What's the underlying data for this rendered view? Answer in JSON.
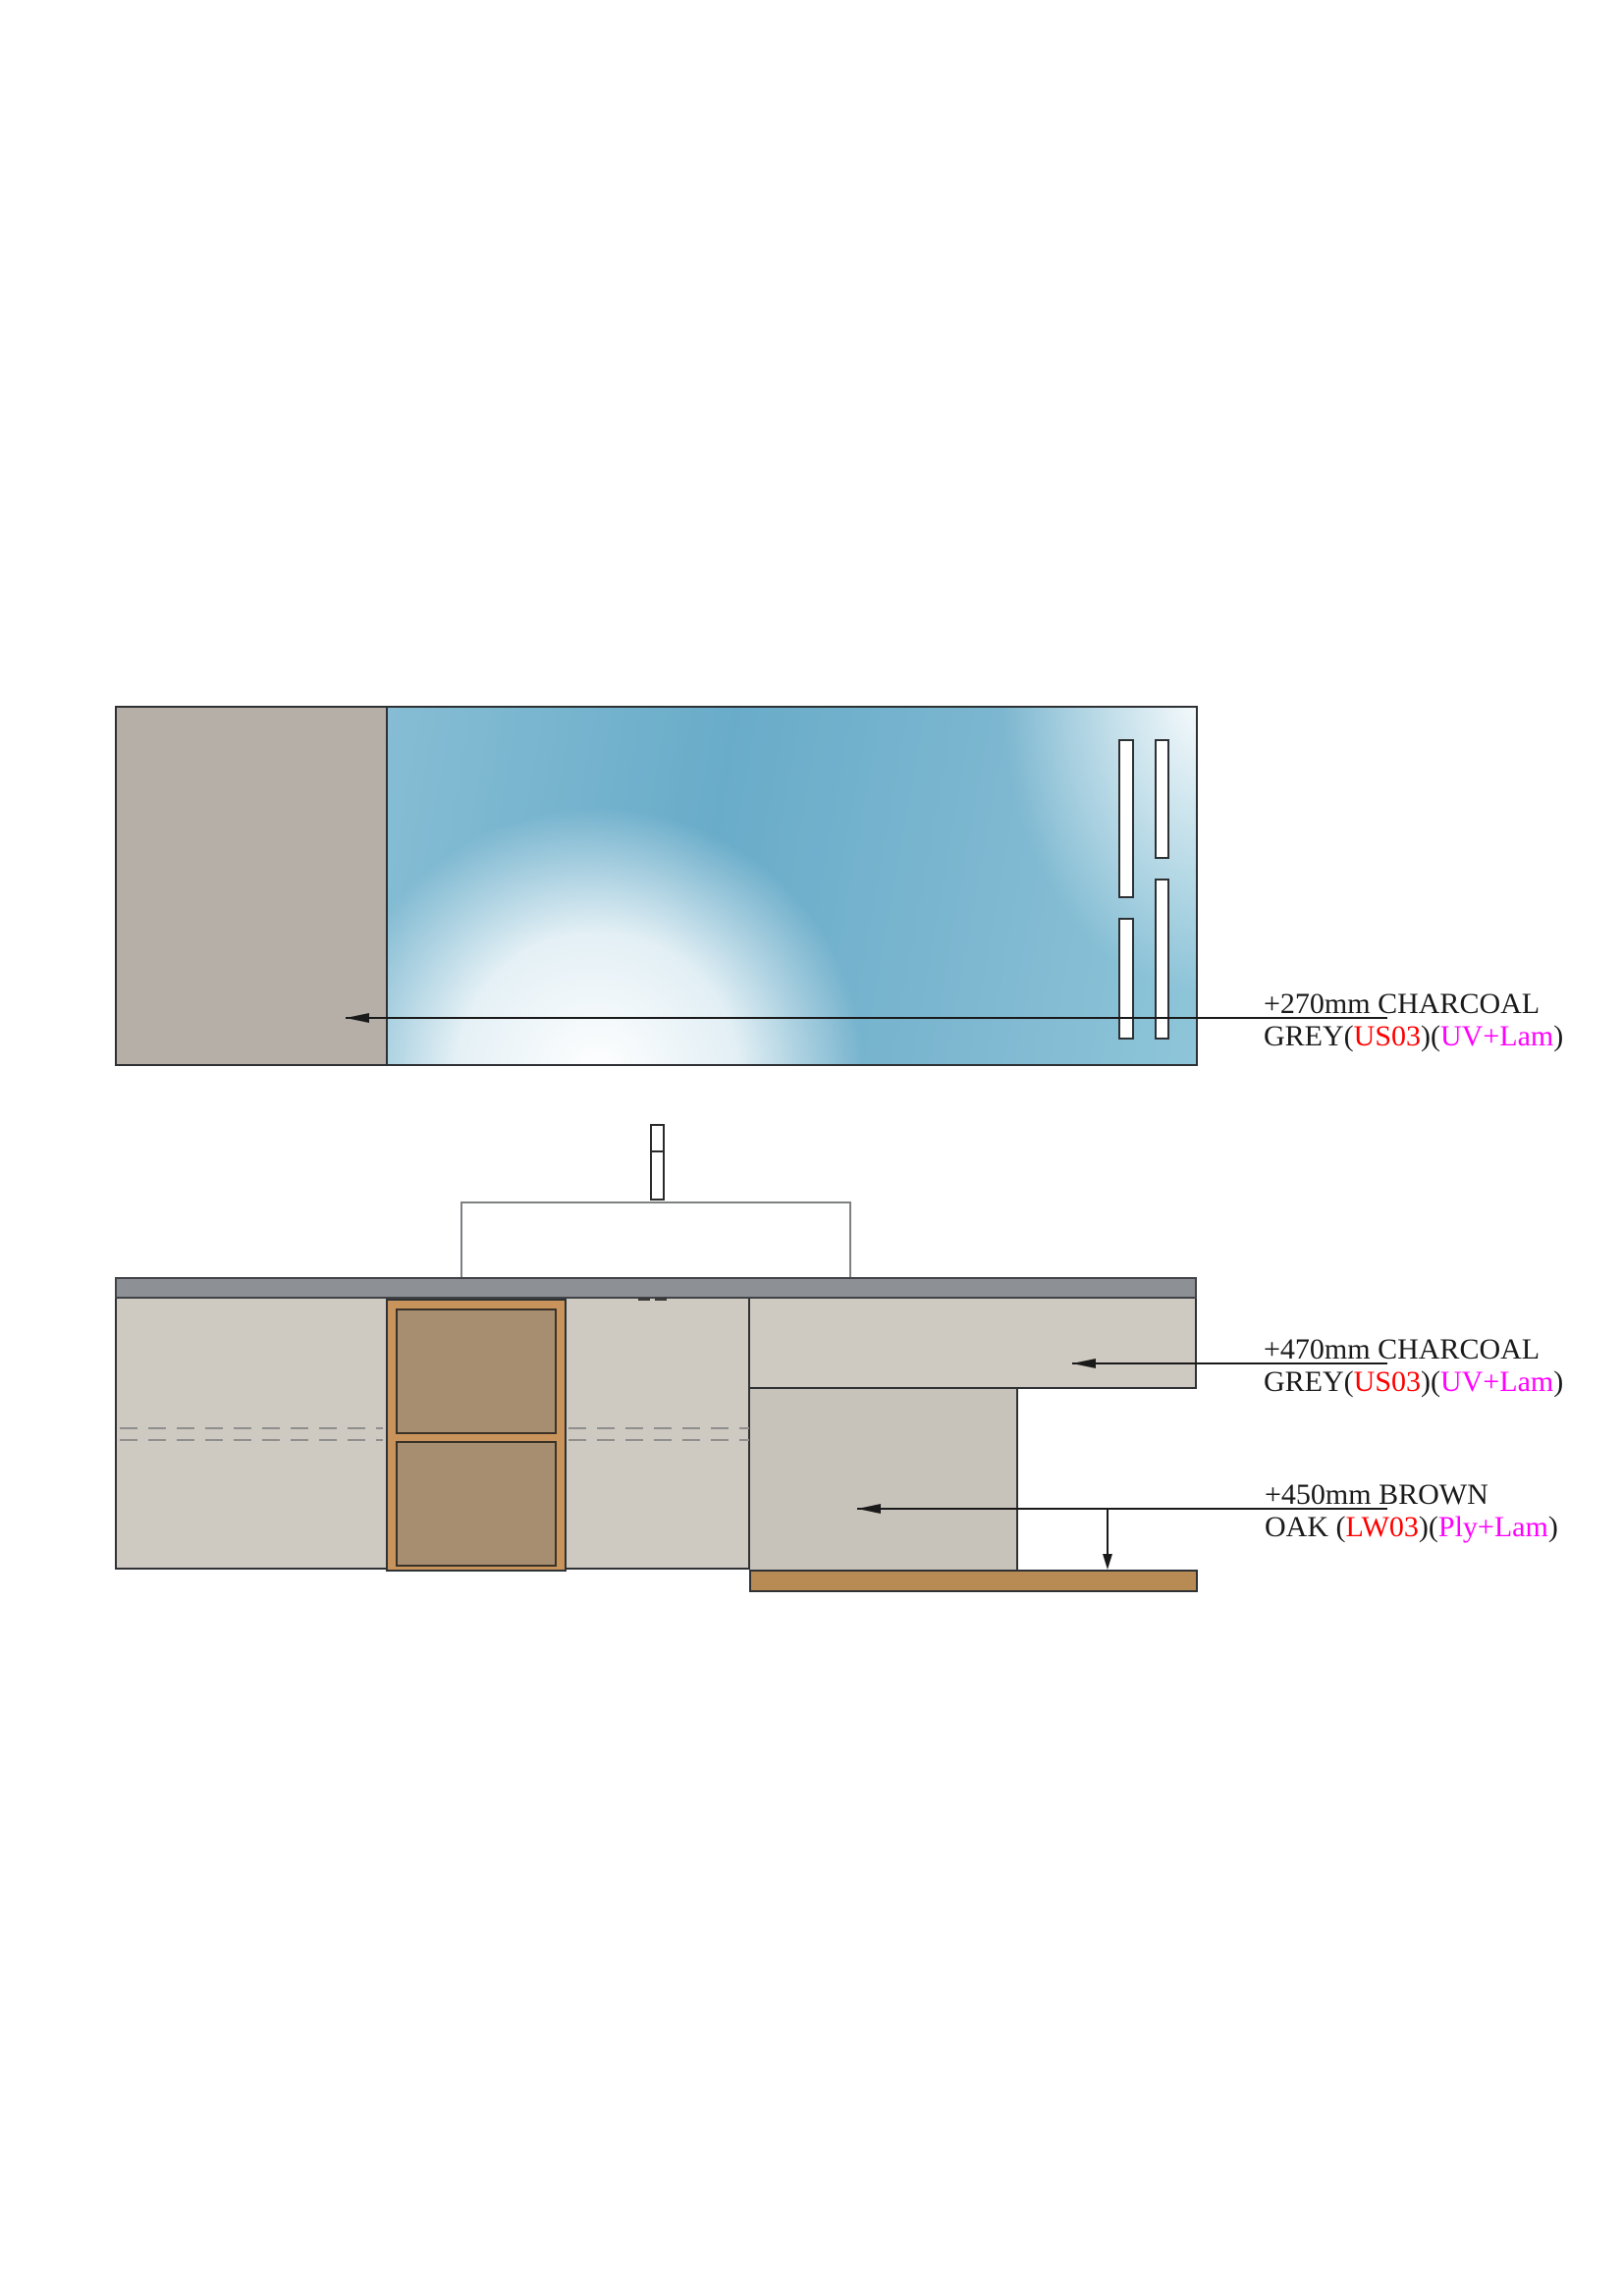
{
  "palette": {
    "ink": "#1a1a1a",
    "red": "#ff0000",
    "magenta": "#ff00ff",
    "taupe": "#b5afa7",
    "panel": "#cec9c1",
    "panel_dark": "#c7c2ba",
    "counter": "#8d9095",
    "wood_frame": "#c8945c",
    "wood_panel": "#a78e71",
    "shelf": "#b88b55",
    "dash": "#8f8f8d",
    "glass_a": "#86bdd4",
    "glass_b": "#69acc9",
    "glass_c": "#7db7d0",
    "glass_d": "#8ec5d9"
  },
  "annotations": [
    {
      "line1": "+270mm CHARCOAL",
      "line2_segments": [
        {
          "text": "GREY(",
          "color": "black"
        },
        {
          "text": "US03",
          "color": "red"
        },
        {
          "text": ")(",
          "color": "black"
        },
        {
          "text": "UV+Lam",
          "color": "magenta"
        },
        {
          "text": ")",
          "color": "black"
        }
      ]
    },
    {
      "line1": "+470mm CHARCOAL",
      "line2_segments": [
        {
          "text": "GREY(",
          "color": "black"
        },
        {
          "text": "US03",
          "color": "red"
        },
        {
          "text": ")(",
          "color": "black"
        },
        {
          "text": "UV+Lam",
          "color": "magenta"
        },
        {
          "text": ")",
          "color": "black"
        }
      ]
    },
    {
      "line1": "+450mm BROWN",
      "line2_segments": [
        {
          "text": "OAK (",
          "color": "black"
        },
        {
          "text": "LW03",
          "color": "red"
        },
        {
          "text": ")(",
          "color": "black"
        },
        {
          "text": "Ply+Lam",
          "color": "magenta"
        },
        {
          "text": ")",
          "color": "black"
        }
      ]
    }
  ]
}
